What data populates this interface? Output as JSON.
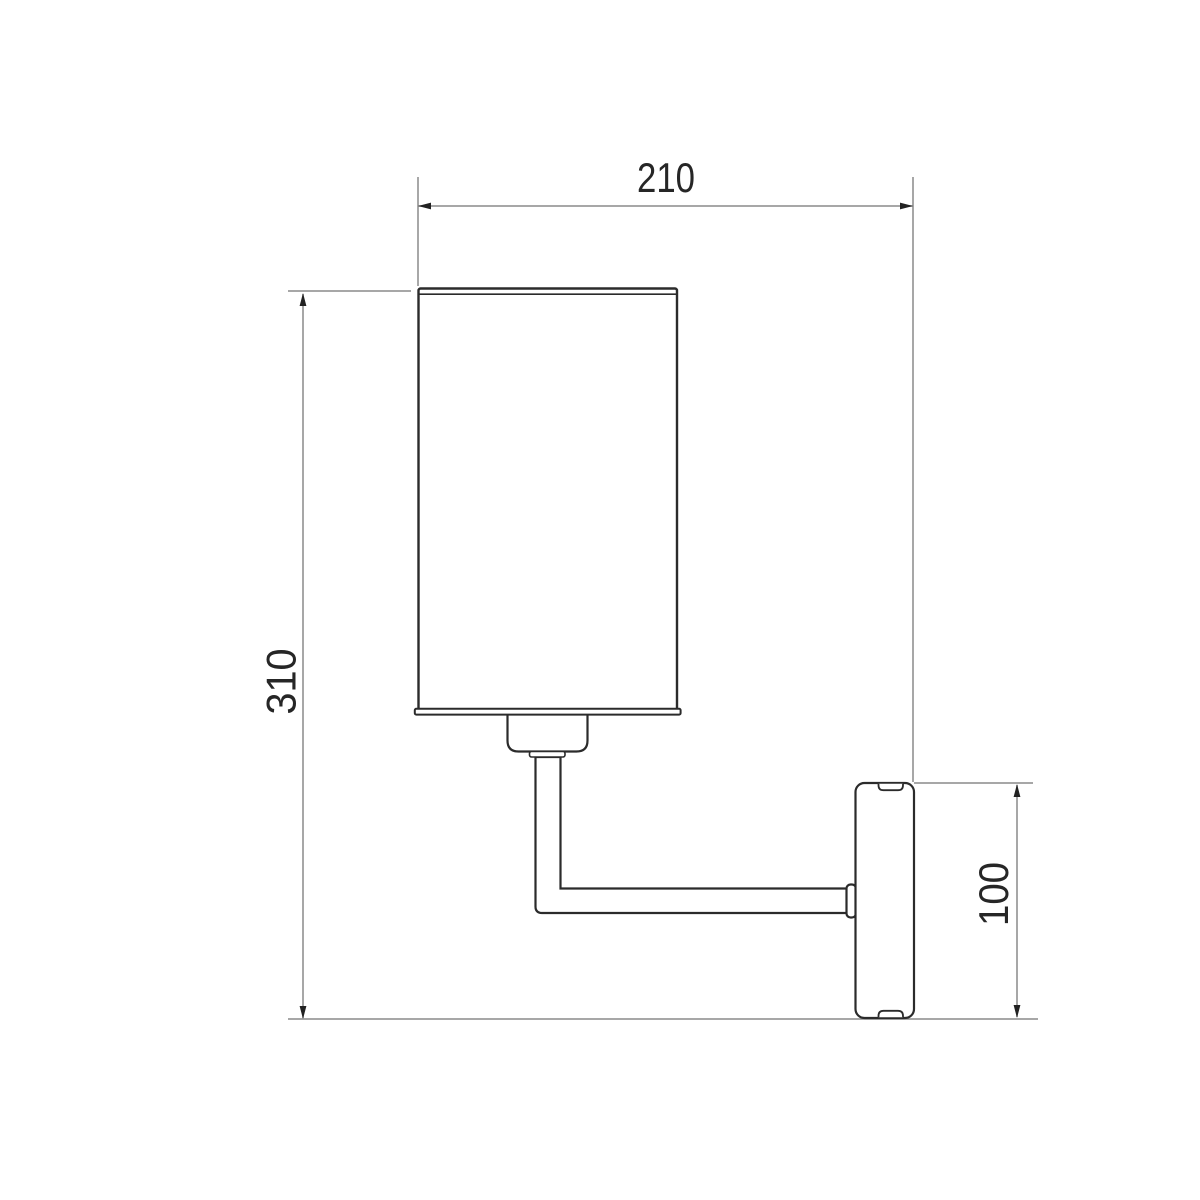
{
  "dimensions": {
    "width": {
      "label": "210"
    },
    "height": {
      "label": "310"
    },
    "backplate": {
      "label": "100"
    }
  },
  "colors": {
    "background": "#ffffff",
    "object_line": "#2b2b2b",
    "dimension_line": "#8a8a8a",
    "label_text": "#262626"
  }
}
